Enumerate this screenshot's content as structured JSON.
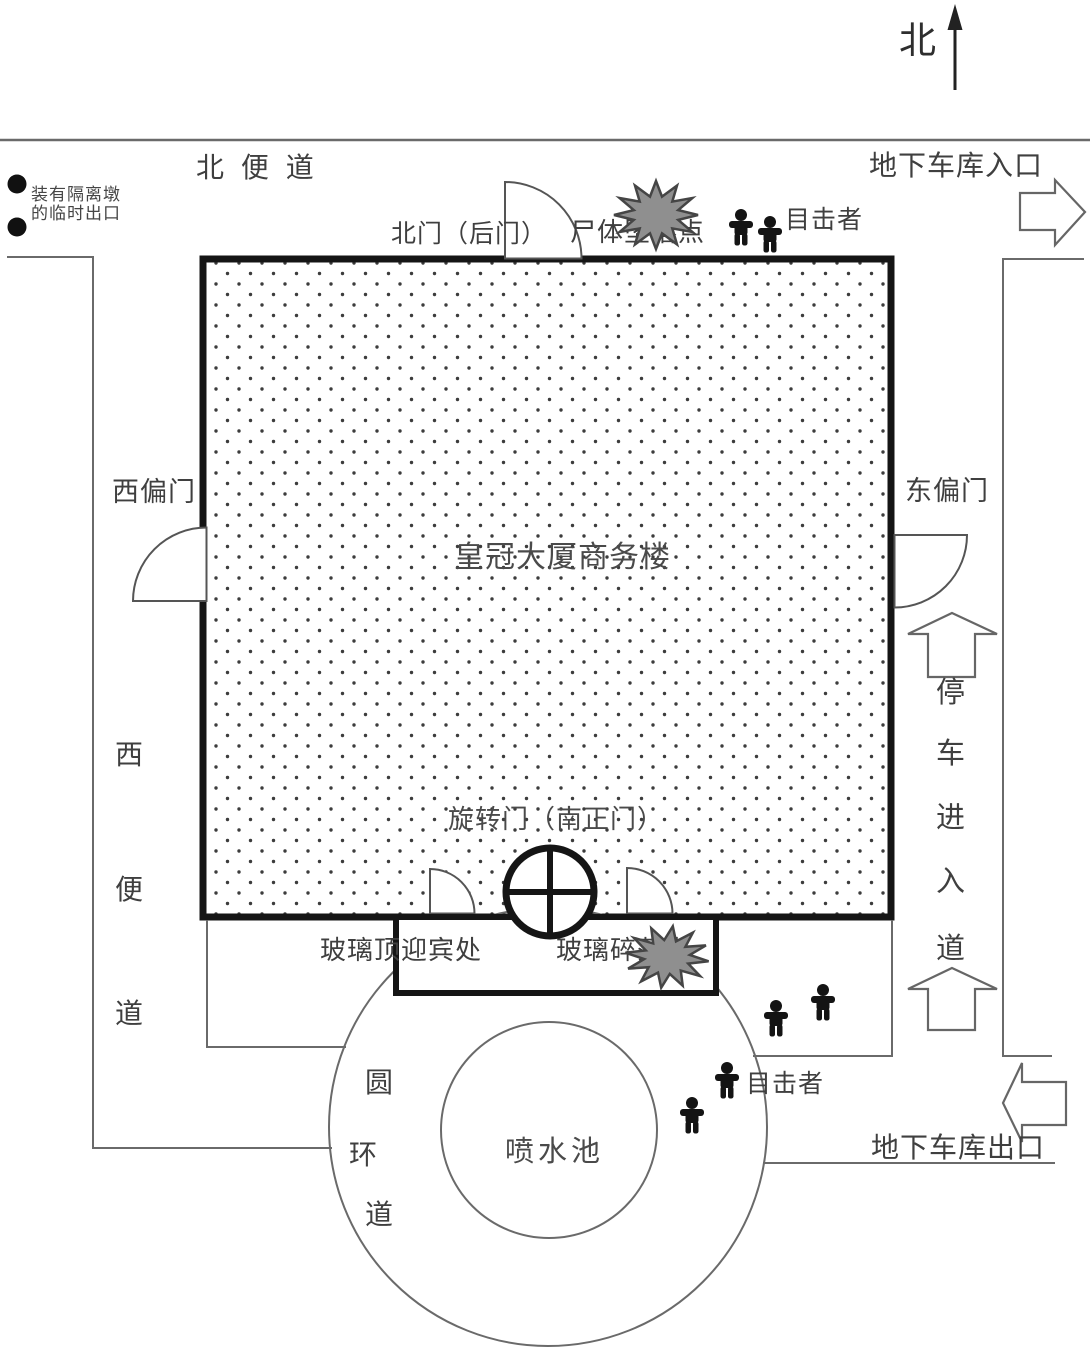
{
  "compass": {
    "north_label": "北"
  },
  "streets": {
    "north_sidewalk": "北 便 道",
    "west_sidewalk": [
      "西",
      "便",
      "道"
    ],
    "parking_lane": [
      "停",
      "车",
      "进",
      "入",
      "道"
    ],
    "ring_road": [
      "圆",
      "环",
      "道"
    ]
  },
  "building": {
    "name": "皇冠大厦商务楼"
  },
  "doors": {
    "north_gate": "北门（后门）",
    "west_gate": "西偏门",
    "east_gate": "东偏门",
    "revolving_door": "旋转门（南正门）"
  },
  "canopy": {
    "label": "玻璃顶迎宾处"
  },
  "fountain": {
    "label": "喷水池"
  },
  "garage": {
    "entrance": "地下车库入口",
    "exit": "地下车库出口"
  },
  "incidents": {
    "body_fall": "尸体坠落点",
    "glass_fall": "玻璃碎落点"
  },
  "witnesses": {
    "north_label": "目击者",
    "north_count": 2,
    "south_label": "目击者",
    "south_count": 4
  },
  "temp_exit": {
    "line1": "装有隔离墩",
    "line2": "的临时出口"
  },
  "icons": {
    "witness_person": "pictogram-person",
    "compass_arrow": "up-arrow",
    "barrier_pier": "filled-circle",
    "impact_burst": "starburst",
    "door_swing": "quarter-arc",
    "traffic_arrow": "outline-block-arrow"
  },
  "colors": {
    "background": "#ffffff",
    "road_line": "#6a6a6a",
    "wall": "#151515",
    "text": "#3f3f3f",
    "burst_fill": "#8f8f8f",
    "burst_stroke": "#454545",
    "person": "#141414",
    "dot_fill": "#3c3c3c"
  }
}
